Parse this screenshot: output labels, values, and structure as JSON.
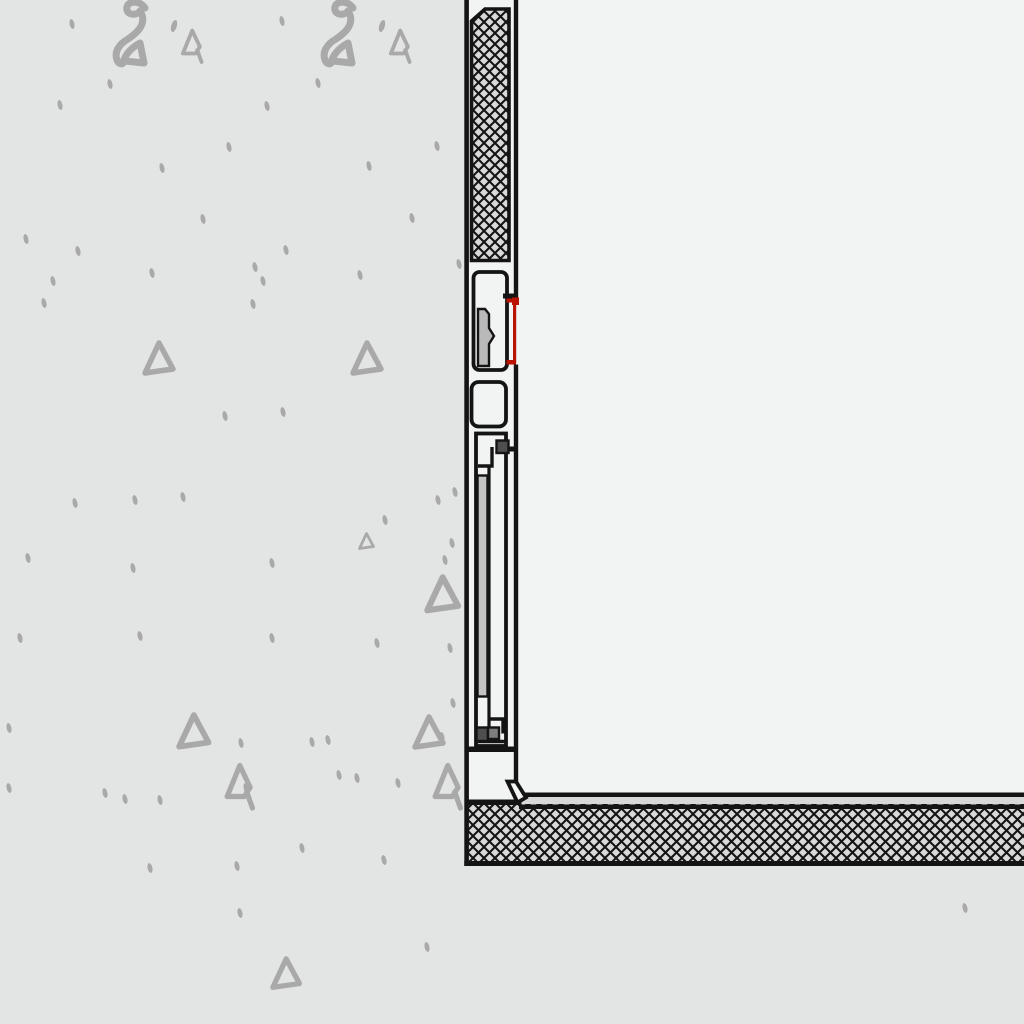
{
  "drawing": {
    "type": "architectural-section-detail",
    "description": "CAD vertical section detail: frame assembly between a concrete wall (left, aggregate-marked) and an interior space (right), with crosshatched insulation strip above, frame profiles with a red-highlighted seal joint, a sill profile with fastening channel, and a crosshatched floor insulation layer at the bottom.",
    "colors": {
      "wall_background": "#e3e4e4",
      "interior_background": "#f2f3f3",
      "line_black": "#141414",
      "hatch_fill": "#d9d9d9",
      "concrete_mark_gray": "#a9a9a9",
      "gasket_gray": "#b9b9b9",
      "bar_gray": "#c3c3c3",
      "block_dark_gray": "#4e4e4e",
      "block_mid_gray": "#7c7c7c",
      "floor_band_gray": "#d8d8d8",
      "accent_red": "#bb1100"
    },
    "components": [
      "concrete-wall",
      "insulation-crosshatch-strip",
      "frame-profile-top",
      "gasket-block",
      "red-highlighted-seal",
      "frame-profile-middle",
      "sill-profile",
      "reinforcement-bar",
      "fastener-blocks",
      "sill-foot",
      "floor-finish-band",
      "floor-insulation-crosshatch",
      "interior-space"
    ]
  },
  "texture_marks": {
    "two_squiggles": [
      [
        112,
        2
      ],
      [
        320,
        2
      ]
    ],
    "apostrophes": [
      [
        171,
        20
      ],
      [
        379,
        20
      ]
    ],
    "a_marks": [
      [
        182,
        28,
        0.85
      ],
      [
        390,
        28,
        0.85
      ],
      [
        226,
        762,
        1.15
      ],
      [
        434,
        762,
        1.15
      ]
    ],
    "triangles": [
      [
        142,
        340,
        1.0
      ],
      [
        350,
        340,
        1.0
      ],
      [
        358,
        532,
        0.5
      ],
      [
        424,
        574,
        1.1
      ],
      [
        176,
        712,
        1.05
      ],
      [
        412,
        714,
        1.0
      ],
      [
        270,
        956,
        0.95
      ]
    ],
    "dots": [
      [
        72,
        24
      ],
      [
        282,
        21
      ],
      [
        110,
        84
      ],
      [
        318,
        83
      ],
      [
        60,
        105
      ],
      [
        267,
        106
      ],
      [
        162,
        168
      ],
      [
        369,
        166
      ],
      [
        229,
        147
      ],
      [
        437,
        146
      ],
      [
        203,
        219
      ],
      [
        412,
        218
      ],
      [
        26,
        239
      ],
      [
        78,
        251
      ],
      [
        152,
        273
      ],
      [
        255,
        267
      ],
      [
        286,
        250
      ],
      [
        360,
        275
      ],
      [
        53,
        281
      ],
      [
        263,
        281
      ],
      [
        253,
        304
      ],
      [
        44,
        303
      ],
      [
        459,
        264
      ],
      [
        225,
        416
      ],
      [
        283,
        412
      ],
      [
        75,
        503
      ],
      [
        135,
        500
      ],
      [
        183,
        497
      ],
      [
        28,
        558
      ],
      [
        133,
        568
      ],
      [
        272,
        563
      ],
      [
        385,
        520
      ],
      [
        438,
        500
      ],
      [
        455,
        492
      ],
      [
        452,
        543
      ],
      [
        445,
        560
      ],
      [
        20,
        638
      ],
      [
        140,
        636
      ],
      [
        272,
        638
      ],
      [
        377,
        643
      ],
      [
        450,
        648
      ],
      [
        453,
        703
      ],
      [
        442,
        737
      ],
      [
        9,
        728
      ],
      [
        9,
        788
      ],
      [
        105,
        793
      ],
      [
        125,
        799
      ],
      [
        160,
        800
      ],
      [
        246,
        788
      ],
      [
        339,
        775
      ],
      [
        357,
        778
      ],
      [
        398,
        783
      ],
      [
        241,
        743
      ],
      [
        312,
        742
      ],
      [
        328,
        740
      ],
      [
        150,
        868
      ],
      [
        237,
        866
      ],
      [
        384,
        860
      ],
      [
        302,
        848
      ],
      [
        240,
        913
      ],
      [
        965,
        908
      ],
      [
        427,
        947
      ]
    ]
  }
}
